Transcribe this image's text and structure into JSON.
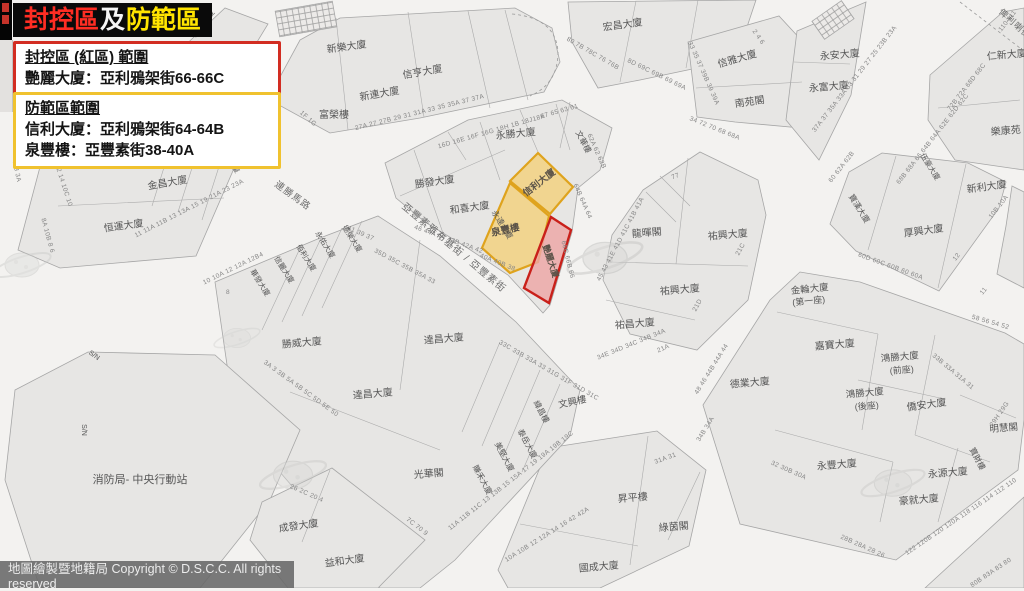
{
  "title": {
    "segments": [
      {
        "text": "封控區",
        "color": "#ff2d23"
      },
      {
        "text": "及",
        "color": "#f5f5f5"
      },
      {
        "text": "防範區",
        "color": "#ffe400"
      }
    ]
  },
  "legend_red": {
    "heading": "封控區 (紅區) 範圍",
    "lines": [
      "艷麗大廈：亞利鴉架街66-66C"
    ]
  },
  "legend_yellow": {
    "heading": "防範區範圍",
    "lines": [
      "信利大廈：亞利鴉架街64-64B",
      "泉豐樓：亞豐素街38-40A"
    ]
  },
  "attribution": "地圖繪製暨地籍局 Copyright © D.S.C.C. All rights reserved",
  "colors": {
    "title_red": "#ff2d23",
    "title_yellow": "#ffe400",
    "red_zone_fill": "#eda6a6",
    "red_zone_stroke": "#c9201a",
    "yellow_zone_fill": "#f3cf79",
    "yellow_zone_stroke": "#dfa31d",
    "street": "#f3f2f0",
    "block": "#e7e6e4"
  },
  "map": {
    "zone_labels": [
      {
        "t": "信利大廈",
        "x": 541,
        "y": 185,
        "r": -38,
        "s": 9.5
      },
      {
        "t": "泉豐樓",
        "x": 506,
        "y": 233,
        "r": -12,
        "s": 9.5
      },
      {
        "t": "艷麗大廈",
        "x": 548,
        "y": 262,
        "r": 72,
        "s": 8.5
      }
    ],
    "street_labels": [
      {
        "t": "亞豐素雅布基街 / 亞豐素街",
        "x": 452,
        "y": 250,
        "r": 40,
        "s": 10
      },
      {
        "t": "連勝馬路",
        "x": 291,
        "y": 198,
        "r": 36,
        "s": 9.5
      },
      {
        "t": "俾利喇街",
        "x": 1013,
        "y": 26,
        "r": 42,
        "s": 9
      }
    ],
    "building_labels": [
      {
        "t": "寶明大廈",
        "x": 205,
        "y": 25,
        "r": -52,
        "s": 8
      },
      {
        "t": "新樂大廈",
        "x": 347,
        "y": 50,
        "r": -8,
        "s": 10
      },
      {
        "t": "信亨大廈",
        "x": 423,
        "y": 75,
        "r": -10,
        "s": 10
      },
      {
        "t": "新連大廈",
        "x": 380,
        "y": 97,
        "r": -10,
        "s": 10
      },
      {
        "t": "富榮樓",
        "x": 334,
        "y": 118,
        "r": 0,
        "s": 10
      },
      {
        "t": "宏昌大廈",
        "x": 623,
        "y": 28,
        "r": -8,
        "s": 10
      },
      {
        "t": "信雅大廈",
        "x": 738,
        "y": 62,
        "r": -16,
        "s": 10
      },
      {
        "t": "南苑閣",
        "x": 750,
        "y": 105,
        "r": -8,
        "s": 10
      },
      {
        "t": "永安大廈",
        "x": 840,
        "y": 58,
        "r": -5,
        "s": 10
      },
      {
        "t": "永富大廈",
        "x": 829,
        "y": 90,
        "r": -5,
        "s": 10
      },
      {
        "t": "仁新大廈",
        "x": 1007,
        "y": 58,
        "r": -5,
        "s": 10
      },
      {
        "t": "樂康苑",
        "x": 1006,
        "y": 134,
        "r": -5,
        "s": 10
      },
      {
        "t": "永勝大廈",
        "x": 516,
        "y": 137,
        "r": -6,
        "s": 10
      },
      {
        "t": "文華樓",
        "x": 581,
        "y": 143,
        "r": 62,
        "s": 8
      },
      {
        "t": "勝發大廈",
        "x": 435,
        "y": 185,
        "r": -8,
        "s": 10
      },
      {
        "t": "和喜大廈",
        "x": 470,
        "y": 211,
        "r": -8,
        "s": 10
      },
      {
        "t": "永達大廈",
        "x": 500,
        "y": 226,
        "r": 58,
        "s": 8
      },
      {
        "t": "金昌大廈",
        "x": 168,
        "y": 186,
        "r": -10,
        "s": 10
      },
      {
        "t": "恒運大廈",
        "x": 124,
        "y": 229,
        "r": -8,
        "s": 10
      },
      {
        "t": "寶興大廈",
        "x": 228,
        "y": 162,
        "r": 55,
        "s": 7
      },
      {
        "t": "龍暉閣",
        "x": 647,
        "y": 236,
        "r": -5,
        "s": 10
      },
      {
        "t": "祐興大廈",
        "x": 728,
        "y": 238,
        "r": -5,
        "s": 10
      },
      {
        "t": "祐興大廈",
        "x": 680,
        "y": 293,
        "r": -5,
        "s": 10
      },
      {
        "t": "祐昌大廈",
        "x": 635,
        "y": 327,
        "r": -5,
        "s": 10
      },
      {
        "t": "厚興大廈",
        "x": 924,
        "y": 234,
        "r": -8,
        "s": 10
      },
      {
        "t": "新利大廈",
        "x": 987,
        "y": 190,
        "r": -8,
        "s": 10
      },
      {
        "t": "寶漢大廈",
        "x": 857,
        "y": 210,
        "r": 58,
        "s": 8
      },
      {
        "t": "伍豪大廈",
        "x": 928,
        "y": 168,
        "r": 58,
        "s": 7.5
      },
      {
        "t": "金輪大廈",
        "x": 810,
        "y": 292,
        "r": -6,
        "s": 9.5
      },
      {
        "t": "(第一座)",
        "x": 809,
        "y": 304,
        "r": -6,
        "s": 9
      },
      {
        "t": "嘉寶大廈",
        "x": 835,
        "y": 348,
        "r": -5,
        "s": 10
      },
      {
        "t": "鴻勝大廈",
        "x": 900,
        "y": 360,
        "r": -5,
        "s": 9.5
      },
      {
        "t": "(前座)",
        "x": 902,
        "y": 373,
        "r": -5,
        "s": 9
      },
      {
        "t": "鴻勝大廈",
        "x": 865,
        "y": 396,
        "r": -5,
        "s": 9.5
      },
      {
        "t": "(後座)",
        "x": 867,
        "y": 409,
        "r": -5,
        "s": 9
      },
      {
        "t": "德業大廈",
        "x": 750,
        "y": 386,
        "r": -5,
        "s": 10
      },
      {
        "t": "僑安大廈",
        "x": 927,
        "y": 408,
        "r": -8,
        "s": 10
      },
      {
        "t": "明慧閣",
        "x": 1004,
        "y": 431,
        "r": -5,
        "s": 9.5
      },
      {
        "t": "寶財樓",
        "x": 975,
        "y": 460,
        "r": 62,
        "s": 8
      },
      {
        "t": "永源大廈",
        "x": 948,
        "y": 476,
        "r": -5,
        "s": 10
      },
      {
        "t": "豪就大廈",
        "x": 919,
        "y": 503,
        "r": -5,
        "s": 10
      },
      {
        "t": "永豐大廈",
        "x": 837,
        "y": 468,
        "r": -5,
        "s": 10
      },
      {
        "t": "達昌大廈",
        "x": 444,
        "y": 342,
        "r": -5,
        "s": 10
      },
      {
        "t": "勝威大廈",
        "x": 302,
        "y": 346,
        "r": -5,
        "s": 10
      },
      {
        "t": "達昌大廈",
        "x": 373,
        "y": 397,
        "r": -5,
        "s": 10
      },
      {
        "t": "光華閣",
        "x": 429,
        "y": 477,
        "r": -5,
        "s": 10
      },
      {
        "t": "文興樓",
        "x": 573,
        "y": 405,
        "r": -12,
        "s": 9.5
      },
      {
        "t": "緯昌樓",
        "x": 539,
        "y": 413,
        "r": 62,
        "s": 8
      },
      {
        "t": "泰岳大廈",
        "x": 525,
        "y": 445,
        "r": 62,
        "s": 8
      },
      {
        "t": "美堅大廈",
        "x": 502,
        "y": 458,
        "r": 62,
        "s": 8
      },
      {
        "t": "賺禾大廈",
        "x": 480,
        "y": 481,
        "r": 62,
        "s": 8
      },
      {
        "t": "昇平樓",
        "x": 633,
        "y": 501,
        "r": -5,
        "s": 10
      },
      {
        "t": "綠茵閣",
        "x": 674,
        "y": 530,
        "r": -5,
        "s": 10
      },
      {
        "t": "國成大廈",
        "x": 599,
        "y": 570,
        "r": -5,
        "s": 10
      },
      {
        "t": "成發大廈",
        "x": 299,
        "y": 529,
        "r": -8,
        "s": 10
      },
      {
        "t": "益和大廈",
        "x": 345,
        "y": 564,
        "r": -8,
        "s": 10
      },
      {
        "t": "消防局- 中央行動站",
        "x": 140,
        "y": 483,
        "r": 0,
        "s": 11
      },
      {
        "t": "華發大廈",
        "x": 258,
        "y": 284,
        "r": 58,
        "s": 7.5
      },
      {
        "t": "信麗大廈",
        "x": 282,
        "y": 271,
        "r": 58,
        "s": 7.5
      },
      {
        "t": "佰利大廈",
        "x": 304,
        "y": 259,
        "r": 58,
        "s": 7.5
      },
      {
        "t": "永佑大廈",
        "x": 323,
        "y": 246,
        "r": 58,
        "s": 7.5
      },
      {
        "t": "德榮大廈",
        "x": 350,
        "y": 240,
        "r": 58,
        "s": 7.5
      },
      {
        "t": "S/N",
        "x": 93,
        "y": 357,
        "r": 35,
        "s": 7
      },
      {
        "t": "S/N",
        "x": 82,
        "y": 430,
        "r": 90,
        "s": 7
      }
    ],
    "lot_numbers": [
      {
        "t": "27A 27 27B 29 31 31A 33 35 35A 37 37A",
        "x": 420,
        "y": 114,
        "r": -14
      },
      {
        "t": "1F 1G",
        "x": 307,
        "y": 120,
        "r": 42
      },
      {
        "t": "16D 16E 16F 16G 18H 1B 18J18K",
        "x": 492,
        "y": 133,
        "r": -16
      },
      {
        "t": "80 7B 78C 76 76B",
        "x": 592,
        "y": 55,
        "r": 30
      },
      {
        "t": "8D 69C 69B 69 69A",
        "x": 656,
        "y": 76,
        "r": 26
      },
      {
        "t": "2 4 6",
        "x": 757,
        "y": 38,
        "r": 55
      },
      {
        "t": "33 35 37 39B 39 39A",
        "x": 702,
        "y": 74,
        "r": 66
      },
      {
        "t": "34 72 70 68 68A",
        "x": 714,
        "y": 130,
        "r": 22
      },
      {
        "t": "37A 37 35A 33A 33 31 29 27 25 23B 23A",
        "x": 856,
        "y": 80,
        "r": -52
      },
      {
        "t": "110 111",
        "x": 1009,
        "y": 22,
        "r": -52
      },
      {
        "t": "72B 72A 68D 68C",
        "x": 968,
        "y": 88,
        "r": -52
      },
      {
        "t": "68B 68A 66 64B 64A 62E 62D 62C",
        "x": 934,
        "y": 140,
        "r": -52
      },
      {
        "t": "60 62A 62B",
        "x": 843,
        "y": 168,
        "r": -52
      },
      {
        "t": "60D 60C 60B 60 60A",
        "x": 890,
        "y": 268,
        "r": 20
      },
      {
        "t": "10B 10A",
        "x": 1000,
        "y": 208,
        "r": -52
      },
      {
        "t": "12",
        "x": 958,
        "y": 258,
        "r": -52
      },
      {
        "t": "11",
        "x": 985,
        "y": 292,
        "r": -52
      },
      {
        "t": "58 56 54 52",
        "x": 990,
        "y": 324,
        "r": 16
      },
      {
        "t": "77",
        "x": 676,
        "y": 178,
        "r": -20
      },
      {
        "t": "45 43 41E 41D 41C 41B 41A",
        "x": 622,
        "y": 240,
        "r": -62
      },
      {
        "t": "21C",
        "x": 742,
        "y": 250,
        "r": -62
      },
      {
        "t": "21D",
        "x": 699,
        "y": 306,
        "r": -62
      },
      {
        "t": "21A",
        "x": 664,
        "y": 350,
        "r": -24
      },
      {
        "t": "34E 34D 34C 34B 34A",
        "x": 632,
        "y": 346,
        "r": -22
      },
      {
        "t": "46 44A 44 43B 42A 42",
        "x": 448,
        "y": 241,
        "r": 20
      },
      {
        "t": "40A 40B 38",
        "x": 497,
        "y": 264,
        "r": 22,
        "c": "#b9872e"
      },
      {
        "t": "64B 64A 64",
        "x": 581,
        "y": 202,
        "r": 66,
        "c": "#b9872e"
      },
      {
        "t": "66C 66B 66",
        "x": 566,
        "y": 260,
        "r": 76,
        "c": "#bb4f44"
      },
      {
        "t": "67 65 63 61",
        "x": 560,
        "y": 113,
        "r": -16
      },
      {
        "t": "62A 62 62B",
        "x": 595,
        "y": 152,
        "r": 66
      },
      {
        "t": "1 3 3A",
        "x": 15,
        "y": 172,
        "r": 78
      },
      {
        "t": "12 14 10C 10",
        "x": 62,
        "y": 186,
        "r": 72
      },
      {
        "t": "8A 10B 8 6",
        "x": 46,
        "y": 236,
        "r": 75
      },
      {
        "t": "11 11A 11B 13 13A 15 19 21A 23 23A",
        "x": 190,
        "y": 210,
        "r": -27
      },
      {
        "t": "10 10A 12 12A 12B4",
        "x": 234,
        "y": 270,
        "r": -26
      },
      {
        "t": "8",
        "x": 228,
        "y": 294,
        "r": 0
      },
      {
        "t": "3A 3 3B 5A 5B 5C 5D 5E 50",
        "x": 300,
        "y": 390,
        "r": 36
      },
      {
        "t": "41 39 37",
        "x": 360,
        "y": 235,
        "r": 24
      },
      {
        "t": "35D 35C 35B 35A 33",
        "x": 404,
        "y": 268,
        "r": 28
      },
      {
        "t": "33C 33B 33A 33 31G 31F 31D 31C",
        "x": 548,
        "y": 372,
        "r": 30
      },
      {
        "t": "7C 70 9",
        "x": 416,
        "y": 528,
        "r": 38
      },
      {
        "t": "11A 11B 11C 13 13B 15 15A 17 19 19A 19B 19C",
        "x": 512,
        "y": 482,
        "r": -38
      },
      {
        "t": "10A 10B 12 12A 14 16 42 42A",
        "x": 548,
        "y": 536,
        "r": -32
      },
      {
        "t": "31A 31",
        "x": 666,
        "y": 460,
        "r": -20
      },
      {
        "t": "48 46 44B 44A 44",
        "x": 713,
        "y": 370,
        "r": -58
      },
      {
        "t": "34B 34A",
        "x": 707,
        "y": 430,
        "r": -58
      },
      {
        "t": "32 30B 30A",
        "x": 788,
        "y": 472,
        "r": 24
      },
      {
        "t": "28B 28A 28 26",
        "x": 862,
        "y": 548,
        "r": 24
      },
      {
        "t": "122 120B 120 120A 118 116 114 112 110",
        "x": 962,
        "y": 518,
        "r": -34
      },
      {
        "t": "80B 83A 83 80",
        "x": 992,
        "y": 574,
        "r": -34
      },
      {
        "t": "29H 29G",
        "x": 1001,
        "y": 415,
        "r": -55
      },
      {
        "t": "33B 33A 31A 31",
        "x": 952,
        "y": 373,
        "r": 40
      },
      {
        "t": "26 2C 20 4",
        "x": 306,
        "y": 495,
        "r": 24
      }
    ]
  }
}
